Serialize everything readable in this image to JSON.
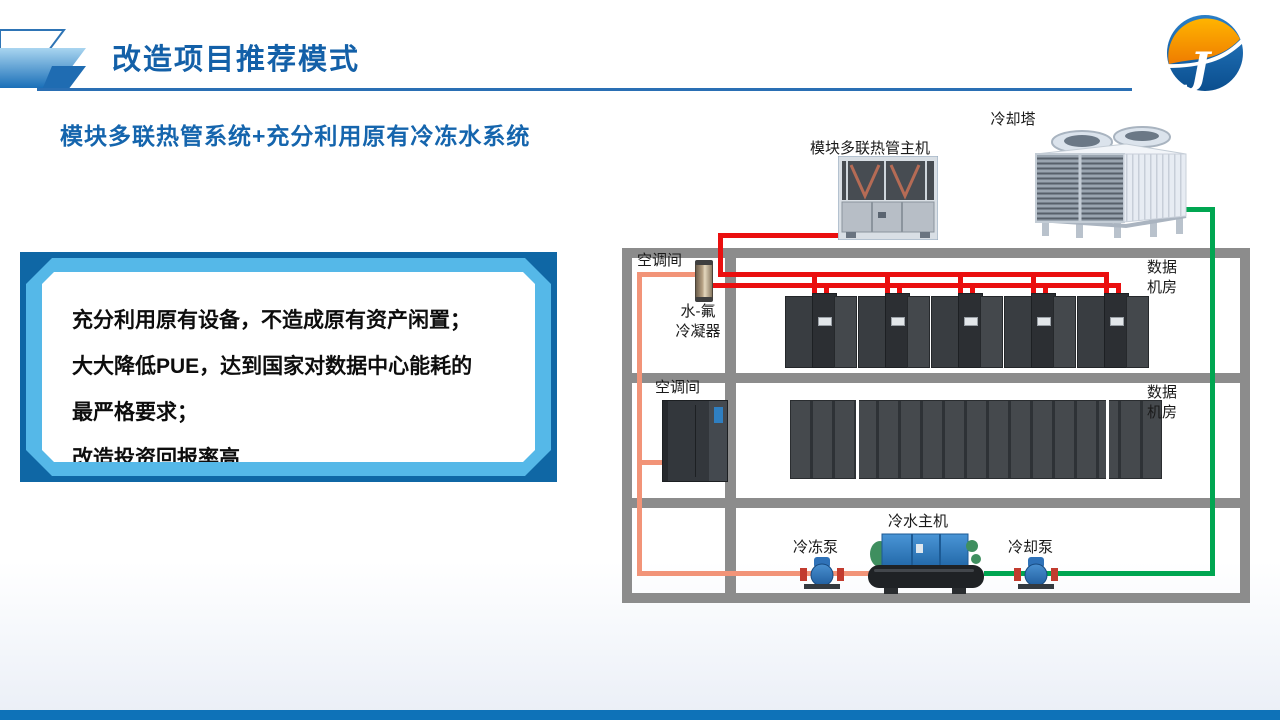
{
  "slide": {
    "title": "改造项目推荐模式",
    "subtitle": "模块多联热管系统+充分利用原有冷冻水系统"
  },
  "benefits": {
    "lines": [
      "充分利用原有设备，不造成原有资产闲置；",
      "大大降低PUE，达到国家对数据中心能耗的",
      "最严格要求；",
      "改造投资回报率高"
    ]
  },
  "diagram": {
    "labels": {
      "heat_pipe_unit": "模块多联热管主机",
      "cooling_tower": "冷却塔",
      "ac_room_1": "空调间",
      "ac_room_2": "空调间",
      "condenser_line1": "水-氟",
      "condenser_line2": "冷凝器",
      "data_room_1": "数据机房",
      "data_room_2": "数据机房",
      "chiller": "冷水主机",
      "chilled_pump": "冷冻泵",
      "cooling_pump": "冷却泵"
    },
    "colors": {
      "refrigerant_pipe_red": "#ea0f0f",
      "chilled_water_pipe_salmon": "#f29478",
      "cooling_water_pipe_green": "#00a651",
      "room_frame_gray": "#8c8c8c"
    }
  },
  "theme": {
    "title_blue": "#1360a8",
    "subtitle_blue": "#1565ad",
    "box_border_blue": "#0f67a5",
    "box_accent_light_blue": "#55b8e8",
    "footer_bar_blue": "#0e72b8"
  }
}
